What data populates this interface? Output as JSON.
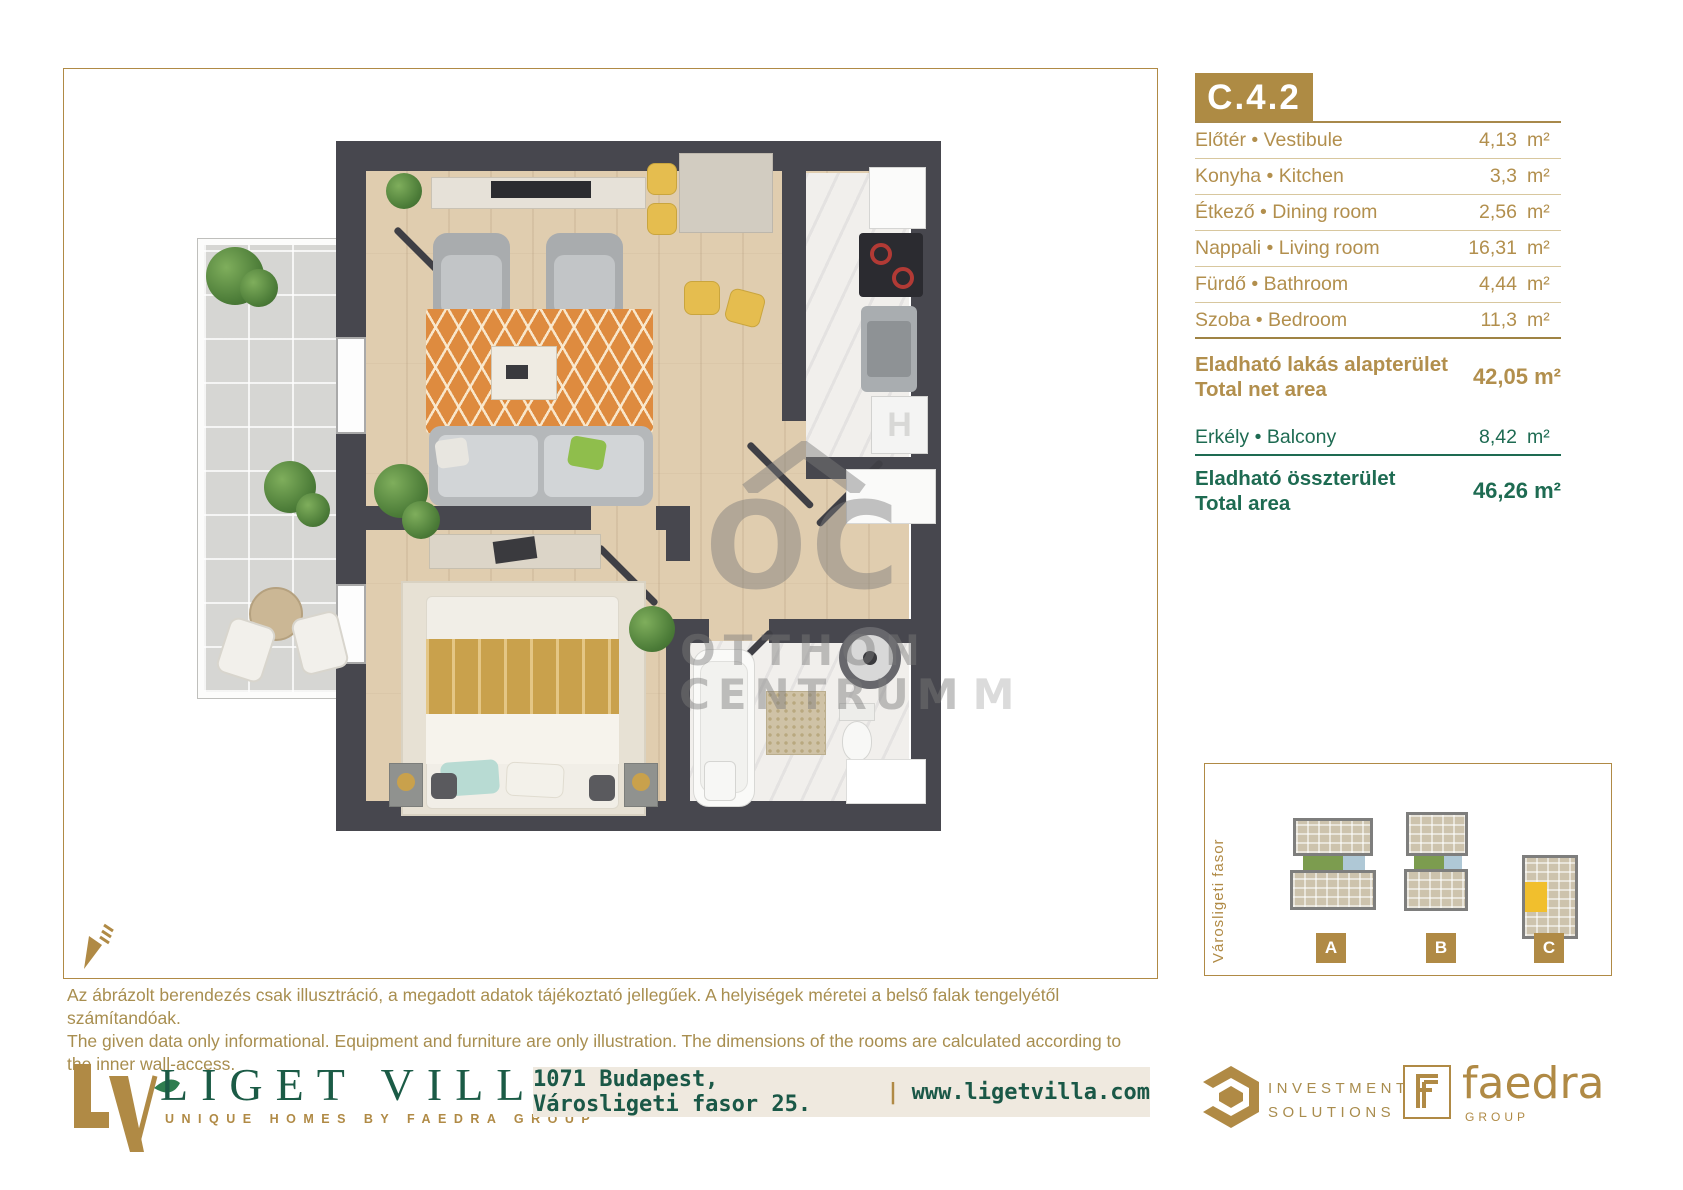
{
  "unit": {
    "code": "C.4.2",
    "rooms": [
      {
        "label": "Előtér • Vestibule",
        "area": "4,13",
        "unit": "m²"
      },
      {
        "label": "Konyha • Kitchen",
        "area": "3,3",
        "unit": "m²"
      },
      {
        "label": "Étkező • Dining room",
        "area": "2,56",
        "unit": "m²"
      },
      {
        "label": "Nappali • Living room",
        "area": "16,31",
        "unit": "m²"
      },
      {
        "label": "Fürdő • Bathroom",
        "area": "4,44",
        "unit": "m²"
      },
      {
        "label": "Szoba • Bedroom",
        "area": "11,3",
        "unit": "m²"
      }
    ],
    "net_area": {
      "label_hu": "Eladható lakás alapterület",
      "label_en": "Total net area",
      "value": "42,05 m²"
    },
    "balcony": {
      "label": "Erkély • Balcony",
      "area": "8,42",
      "unit": "m²"
    },
    "total_area": {
      "label_hu": "Eladható összterület",
      "label_en": "Total area",
      "value": "46,26 m²"
    }
  },
  "plan": {
    "tile_letter": "H"
  },
  "watermark": {
    "monogram": "OC",
    "line1": "OTTHON",
    "line2": "CENTRUM",
    "stray": "M"
  },
  "sitemap": {
    "street": "Városligeti fasor",
    "buildings": [
      {
        "label": "A"
      },
      {
        "label": "B"
      },
      {
        "label": "C"
      }
    ]
  },
  "disclaimer": {
    "hu": "Az ábrázolt berendezés csak illusztráció, a megadott adatok tájékoztató jellegűek. A helyiségek méretei a belső falak tengelyétől számítandóak.",
    "en": "The given data only informational. Equipment and furniture are only illustration. The dimensions of the rooms are calculated according to the inner wall-access."
  },
  "footer": {
    "brand": "LIGET VILLA",
    "tagline": "UNIQUE HOMES BY FAEDRA GROUP",
    "address": "1071 Budapest, Városligeti fasor 25.",
    "separator": "|",
    "website": "www.ligetvilla.com",
    "investment": {
      "line1": "INVESTMENT",
      "line2": "SOLUTIONS"
    },
    "faedra": {
      "name": "faedra",
      "group": "GROUP"
    }
  },
  "colors": {
    "gold": "#AE8B44",
    "green": "#1E6B52",
    "brand_green": "#1B5B46",
    "wall": "#47474E",
    "highlight_yellow": "#F1BF2D"
  }
}
